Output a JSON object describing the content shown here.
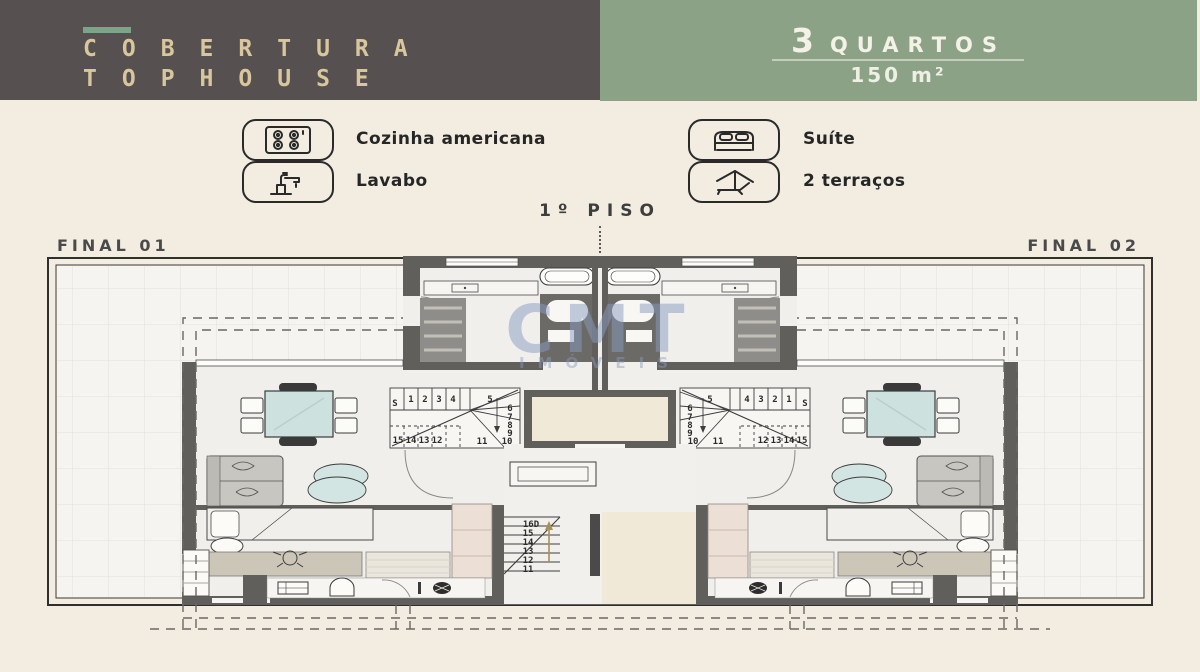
{
  "header": {
    "title_line1": "COBERTURA",
    "title_line2": "TOPHOUSE",
    "bedrooms_number": "3",
    "bedrooms_label": "QUARTOS",
    "area": "150 m²"
  },
  "legend": {
    "items": [
      {
        "icon": "stove-icon",
        "label": "Cozinha americana"
      },
      {
        "icon": "faucet-icon",
        "label": "Lavabo"
      },
      {
        "icon": "bed-icon",
        "label": "Suíte"
      },
      {
        "icon": "umbrella-icon",
        "label": "2 terraços"
      }
    ]
  },
  "plan": {
    "floor_label": "1º PISO",
    "unit_left_label": "FINAL 01",
    "unit_right_label": "FINAL 02",
    "watermark_line1": "CMT",
    "watermark_line2": "IMÓVEIS",
    "stairs_upper": {
      "up_label": "S",
      "top_row": [
        "1",
        "2",
        "3",
        "4"
      ],
      "turn": "5",
      "side_col": [
        "6",
        "7",
        "8",
        "9",
        "10"
      ],
      "bottom_row": [
        "15",
        "14",
        "13",
        "12"
      ],
      "corner": "11"
    },
    "stairs_lower": [
      "16D",
      "15",
      "14",
      "13",
      "12",
      "11"
    ]
  },
  "colors": {
    "header_dark": "#575050",
    "header_gold": "#d8c79c",
    "header_green": "#8ba287",
    "accent_green": "#7ca489",
    "background": "#f2ede0",
    "wall": "#605f5c",
    "furniture_teal": "#cde2df",
    "closet_pink": "#ecdfd6",
    "core_beige": "#f0e9d7",
    "watermark_blue": "#8a9cc0"
  }
}
